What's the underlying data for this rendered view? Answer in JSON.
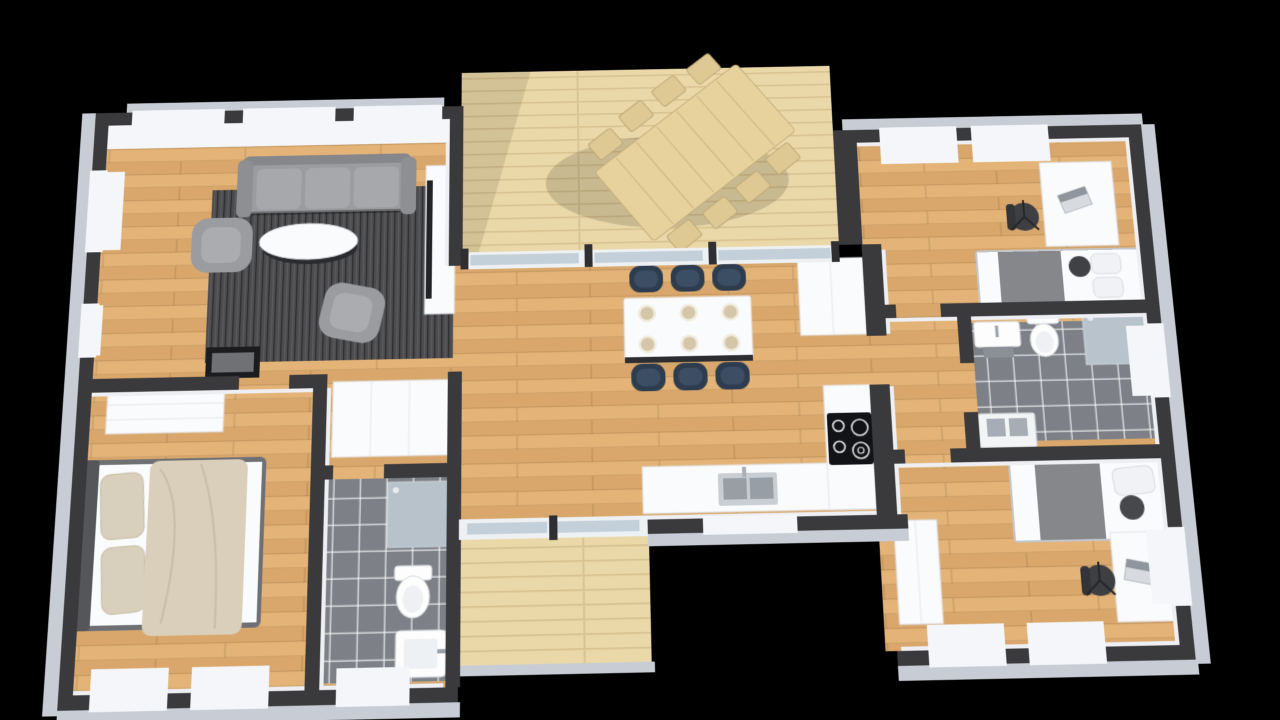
{
  "scene": {
    "type": "3d-floor-plan-render",
    "view": "isometric top-down dollhouse view of a single-storey house",
    "background": "#000000"
  },
  "palette": {
    "background": "#000000",
    "wall_dark": "#3a3a3d",
    "wall_face": "#edeff3",
    "wall_outer": "#c8cdd5",
    "window_white": "#f4f6f9",
    "glass": "#c3d0da",
    "white_furniture": "#fafbfd",
    "wood_floor": "#dcab70",
    "deck_wood": "#ead8a8",
    "tile": "#7d8187",
    "rug": "#4d4d50",
    "sofa_gray": "#9a9ca0",
    "navy_chair": "#2d3c4e",
    "appliance_dark": "#2e2f33",
    "cooktop_black": "#121316",
    "bed_blanket_gray": "#85878b",
    "pillow_beige": "#d8cfbc",
    "duvet_beige": "#d9cfba",
    "plate_beige": "#d4c6a8",
    "outdoor_wood": "#e7d29e"
  },
  "rooms": [
    {
      "name": "Living Room",
      "floor": "oak wood",
      "furniture": [
        "gray 3-seat sofa",
        "2 gray armchairs",
        "white oval coffee table",
        "dark gray area rug",
        "TV on white sideboard",
        "black fireplace unit"
      ]
    },
    {
      "name": "Open Dining / Kitchen",
      "floor": "oak wood",
      "furniture": [
        "white dining table with 6 place settings",
        "6 navy dining chairs",
        "L-shaped white kitchen counter",
        "black 4-zone cooktop",
        "double kitchen sink",
        "white fridge cabinet block"
      ]
    },
    {
      "name": "Master Bedroom",
      "floor": "oak wood",
      "furniture": [
        "double bed with beige pillows and beige throw",
        "dark upholstered headboard",
        "white dresser"
      ]
    },
    {
      "name": "Hall Closet",
      "floor": "oak wood",
      "furniture": [
        "white wardrobe"
      ]
    },
    {
      "name": "Bathroom 1",
      "floor": "gray tile",
      "furniture": [
        "walk-in glass shower",
        "toilet",
        "washbasin"
      ]
    },
    {
      "name": "Bedroom 2",
      "floor": "oak wood",
      "furniture": [
        "single bed with gray blanket",
        "white desk with laptop",
        "black office chair"
      ]
    },
    {
      "name": "Bathroom 2 / Laundry",
      "floor": "gray tile",
      "furniture": [
        "walk-in glass shower",
        "toilet",
        "wall basin",
        "laundry counter with twin sinks"
      ]
    },
    {
      "name": "Bedroom 3",
      "floor": "oak wood",
      "furniture": [
        "single bed with gray blanket",
        "white desk with laptop",
        "black office chair",
        "white wardrobe"
      ]
    },
    {
      "name": "Main Terrace",
      "floor": "pale deck planks",
      "furniture": [
        "large outdoor dining table rotated diagonally",
        "8 slatted outdoor chairs"
      ]
    },
    {
      "name": "Small Terrace",
      "floor": "pale deck planks",
      "furniture": []
    }
  ],
  "counts": {
    "bedrooms": 3,
    "bathrooms": 2,
    "terraces": 2,
    "dining_chairs_inside": 6,
    "outdoor_chairs": 8
  }
}
